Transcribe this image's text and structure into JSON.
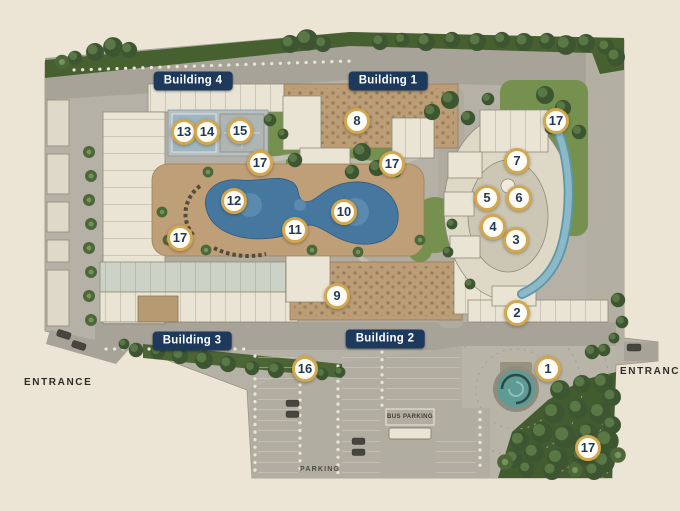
{
  "map": {
    "building_labels": [
      {
        "label": "Building 4",
        "x": 193,
        "y": 81
      },
      {
        "label": "Building 1",
        "x": 388,
        "y": 81
      },
      {
        "label": "Building 3",
        "x": 192,
        "y": 341
      },
      {
        "label": "Building 2",
        "x": 385,
        "y": 339
      }
    ],
    "markers": [
      {
        "number": "1",
        "x": 548,
        "y": 369
      },
      {
        "number": "2",
        "x": 517,
        "y": 313
      },
      {
        "number": "3",
        "x": 516,
        "y": 240
      },
      {
        "number": "4",
        "x": 493,
        "y": 227
      },
      {
        "number": "5",
        "x": 487,
        "y": 198
      },
      {
        "number": "6",
        "x": 519,
        "y": 198
      },
      {
        "number": "7",
        "x": 517,
        "y": 161
      },
      {
        "number": "8",
        "x": 357,
        "y": 121
      },
      {
        "number": "9",
        "x": 337,
        "y": 296
      },
      {
        "number": "10",
        "x": 344,
        "y": 212
      },
      {
        "number": "11",
        "x": 295,
        "y": 230
      },
      {
        "number": "12",
        "x": 234,
        "y": 201
      },
      {
        "number": "13",
        "x": 184,
        "y": 132
      },
      {
        "number": "14",
        "x": 207,
        "y": 132
      },
      {
        "number": "15",
        "x": 240,
        "y": 131
      },
      {
        "number": "16",
        "x": 305,
        "y": 369
      },
      {
        "number": "17",
        "x": 556,
        "y": 121
      },
      {
        "number": "17",
        "x": 392,
        "y": 164
      },
      {
        "number": "17",
        "x": 260,
        "y": 163
      },
      {
        "number": "17",
        "x": 180,
        "y": 238
      },
      {
        "number": "17",
        "x": 588,
        "y": 448
      }
    ],
    "texts": {
      "entrance_left": "ENTRANCE",
      "entrance_right": "ENTRANCE",
      "parking": "PARKING",
      "bus_parking": "BUS PARKING"
    },
    "colors": {
      "background": "#ece4d4",
      "label_bg": "#1d3a5d",
      "label_text": "#ffffff",
      "marker_ring": "#d2a74f",
      "marker_number": "#1d3a5d",
      "pool_water": "#46789f",
      "fountain_water": "#5f9a95"
    }
  }
}
